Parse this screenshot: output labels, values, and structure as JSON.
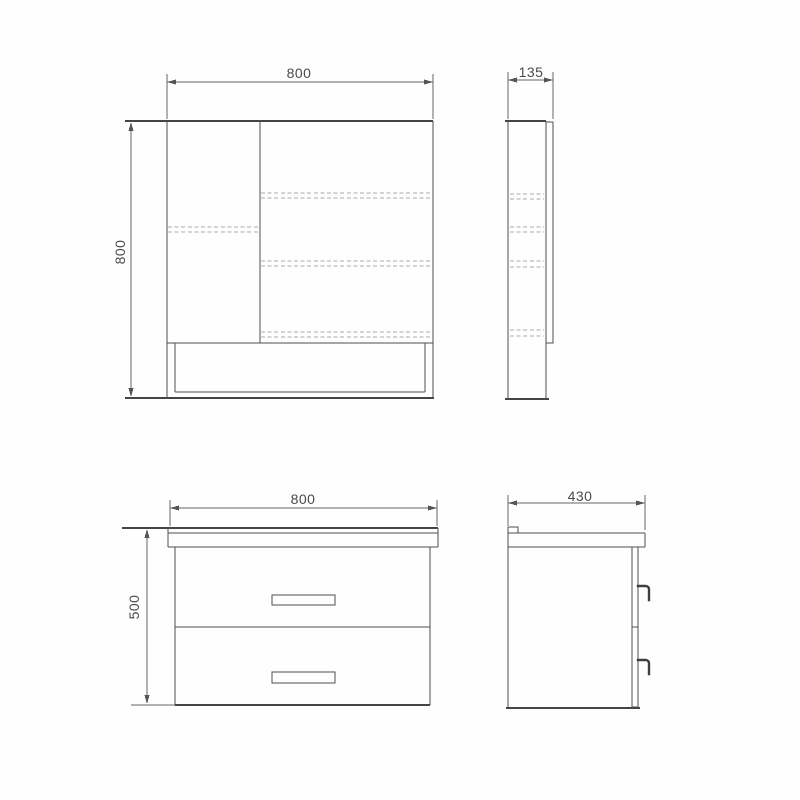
{
  "dimensions": {
    "mirror_front_width": "800",
    "mirror_front_height": "800",
    "mirror_side_depth": "135",
    "vanity_front_width": "800",
    "vanity_front_height": "500",
    "vanity_side_depth": "430"
  },
  "colors": {
    "outline": "#4f4f4f",
    "heavy_line": "#454545",
    "dimension_line": "#666666",
    "hidden_line": "#ababab",
    "label_text": "#4a4a4a",
    "background": "#fefefe"
  }
}
